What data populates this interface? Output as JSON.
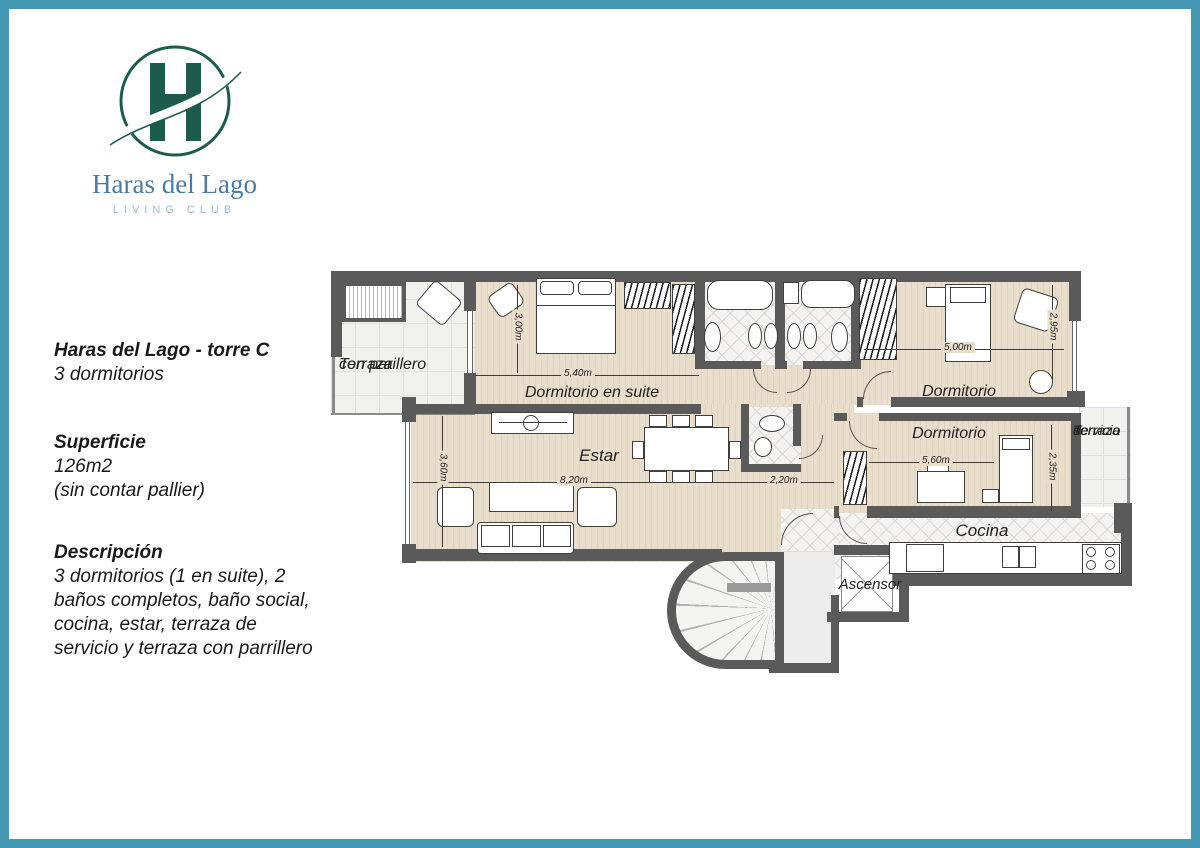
{
  "colors": {
    "accent_teal": "#4598b3",
    "logo_green": "#1d5c4c",
    "logo_name_blue": "#4a7ba0",
    "tagline_blue": "#9ab9cb",
    "wall_gray": "#5a5a5a"
  },
  "logo": {
    "monogram": "H",
    "name": "Haras del Lago",
    "tagline": "LIVING CLUB"
  },
  "info": {
    "title": "Haras del Lago - torre C",
    "subtitle": "3 dormitorios",
    "surface_heading": "Superficie",
    "surface_value": "126m2",
    "surface_note": "(sin contar pallier)",
    "description_heading": "Descripción",
    "description_body": "3 dormitorios (1 en suite), 2 baños completos, baño social, cocina, estar, terraza de servicio y terraza con parrillero"
  },
  "plan": {
    "rooms": {
      "terraza_parrillero": {
        "line1": "Terraza",
        "line2": "con parillero"
      },
      "dormitorio_suite": "Dormitorio en suite",
      "dormitorio_2": "Dormitorio",
      "dormitorio_3": "Dormitorio",
      "estar": "Estar",
      "cocina": "Cocina",
      "ascensor": "Ascensor",
      "terraza_servicio": {
        "line1": "Terraza",
        "line2": "de",
        "line3": "servicio"
      }
    },
    "dimensions": {
      "suite_width": "5,40m",
      "suite_depth": "3,00m",
      "dorm2_width": "5,00m",
      "dorm2_depth": "2,95m",
      "estar_width": "8,20m",
      "estar_depth": "3,60m",
      "pasillo_width": "2,20m",
      "dorm3_width": "5,60m",
      "dorm3_depth": "2,35m"
    }
  }
}
